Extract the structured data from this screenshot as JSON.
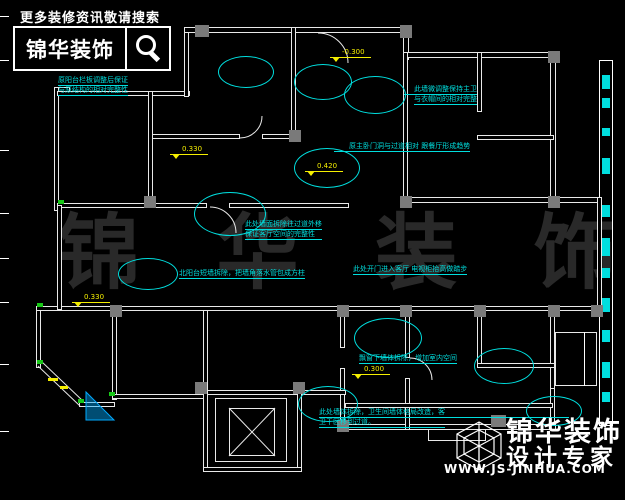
{
  "header": {
    "tagline": "更多装修资讯敬请搜索",
    "brand": "锦华装饰",
    "search_icon": "magnifier-icon"
  },
  "watermark": {
    "text": "锦 华 装 饰"
  },
  "footer": {
    "cube_icon": "cube-wireframe-icon",
    "brand": "锦华装饰",
    "subtitle": "设计专家",
    "website": "WWW.JS-JINHUA.COM"
  },
  "plan": {
    "annotations": [
      {
        "id": "balcony-note",
        "lines": [
          "原阳台栏板调整后保证",
          "与原结构的相对完整性"
        ]
      },
      {
        "id": "master-bath-note",
        "lines": [
          "此墙微调整保持主卫",
          "与衣帽间的相对完整"
        ]
      },
      {
        "id": "doorway-note",
        "lines": [
          "原主卧门洞与过道相对 跟餐厅形成趋势"
        ]
      },
      {
        "id": "wall-move-note",
        "lines": [
          "此处墙面拆除往过道外移",
          "保证客厅空间的完整性"
        ]
      },
      {
        "id": "north-balcony-note",
        "lines": [
          "北阳台短墙拆除，把墙角落水管包成方柱"
        ]
      },
      {
        "id": "entry-note",
        "lines": [
          "此处开门进入客厅  电视柜抬高做踏步"
        ]
      },
      {
        "id": "bay-window-note",
        "lines": [
          "飘窗下墙体拆除，增加室内空间"
        ]
      },
      {
        "id": "bathroom-note",
        "lines": [
          "此处墙体拆除，卫生间墙体格局改造，客",
          "卫干区移到过道。"
        ]
      }
    ],
    "levels": [
      {
        "value": "-0.300"
      },
      {
        "value": "0.330"
      },
      {
        "value": "0.420"
      },
      {
        "value": "0.330"
      },
      {
        "value": "0.300"
      }
    ],
    "colors": {
      "annotation": "#00DEDE",
      "level": "#F5EF00",
      "wall": "#E9E9E9",
      "column": "#7A7A7A",
      "green_mark": "#18C818",
      "blue_fill": "#00AAFF"
    }
  }
}
